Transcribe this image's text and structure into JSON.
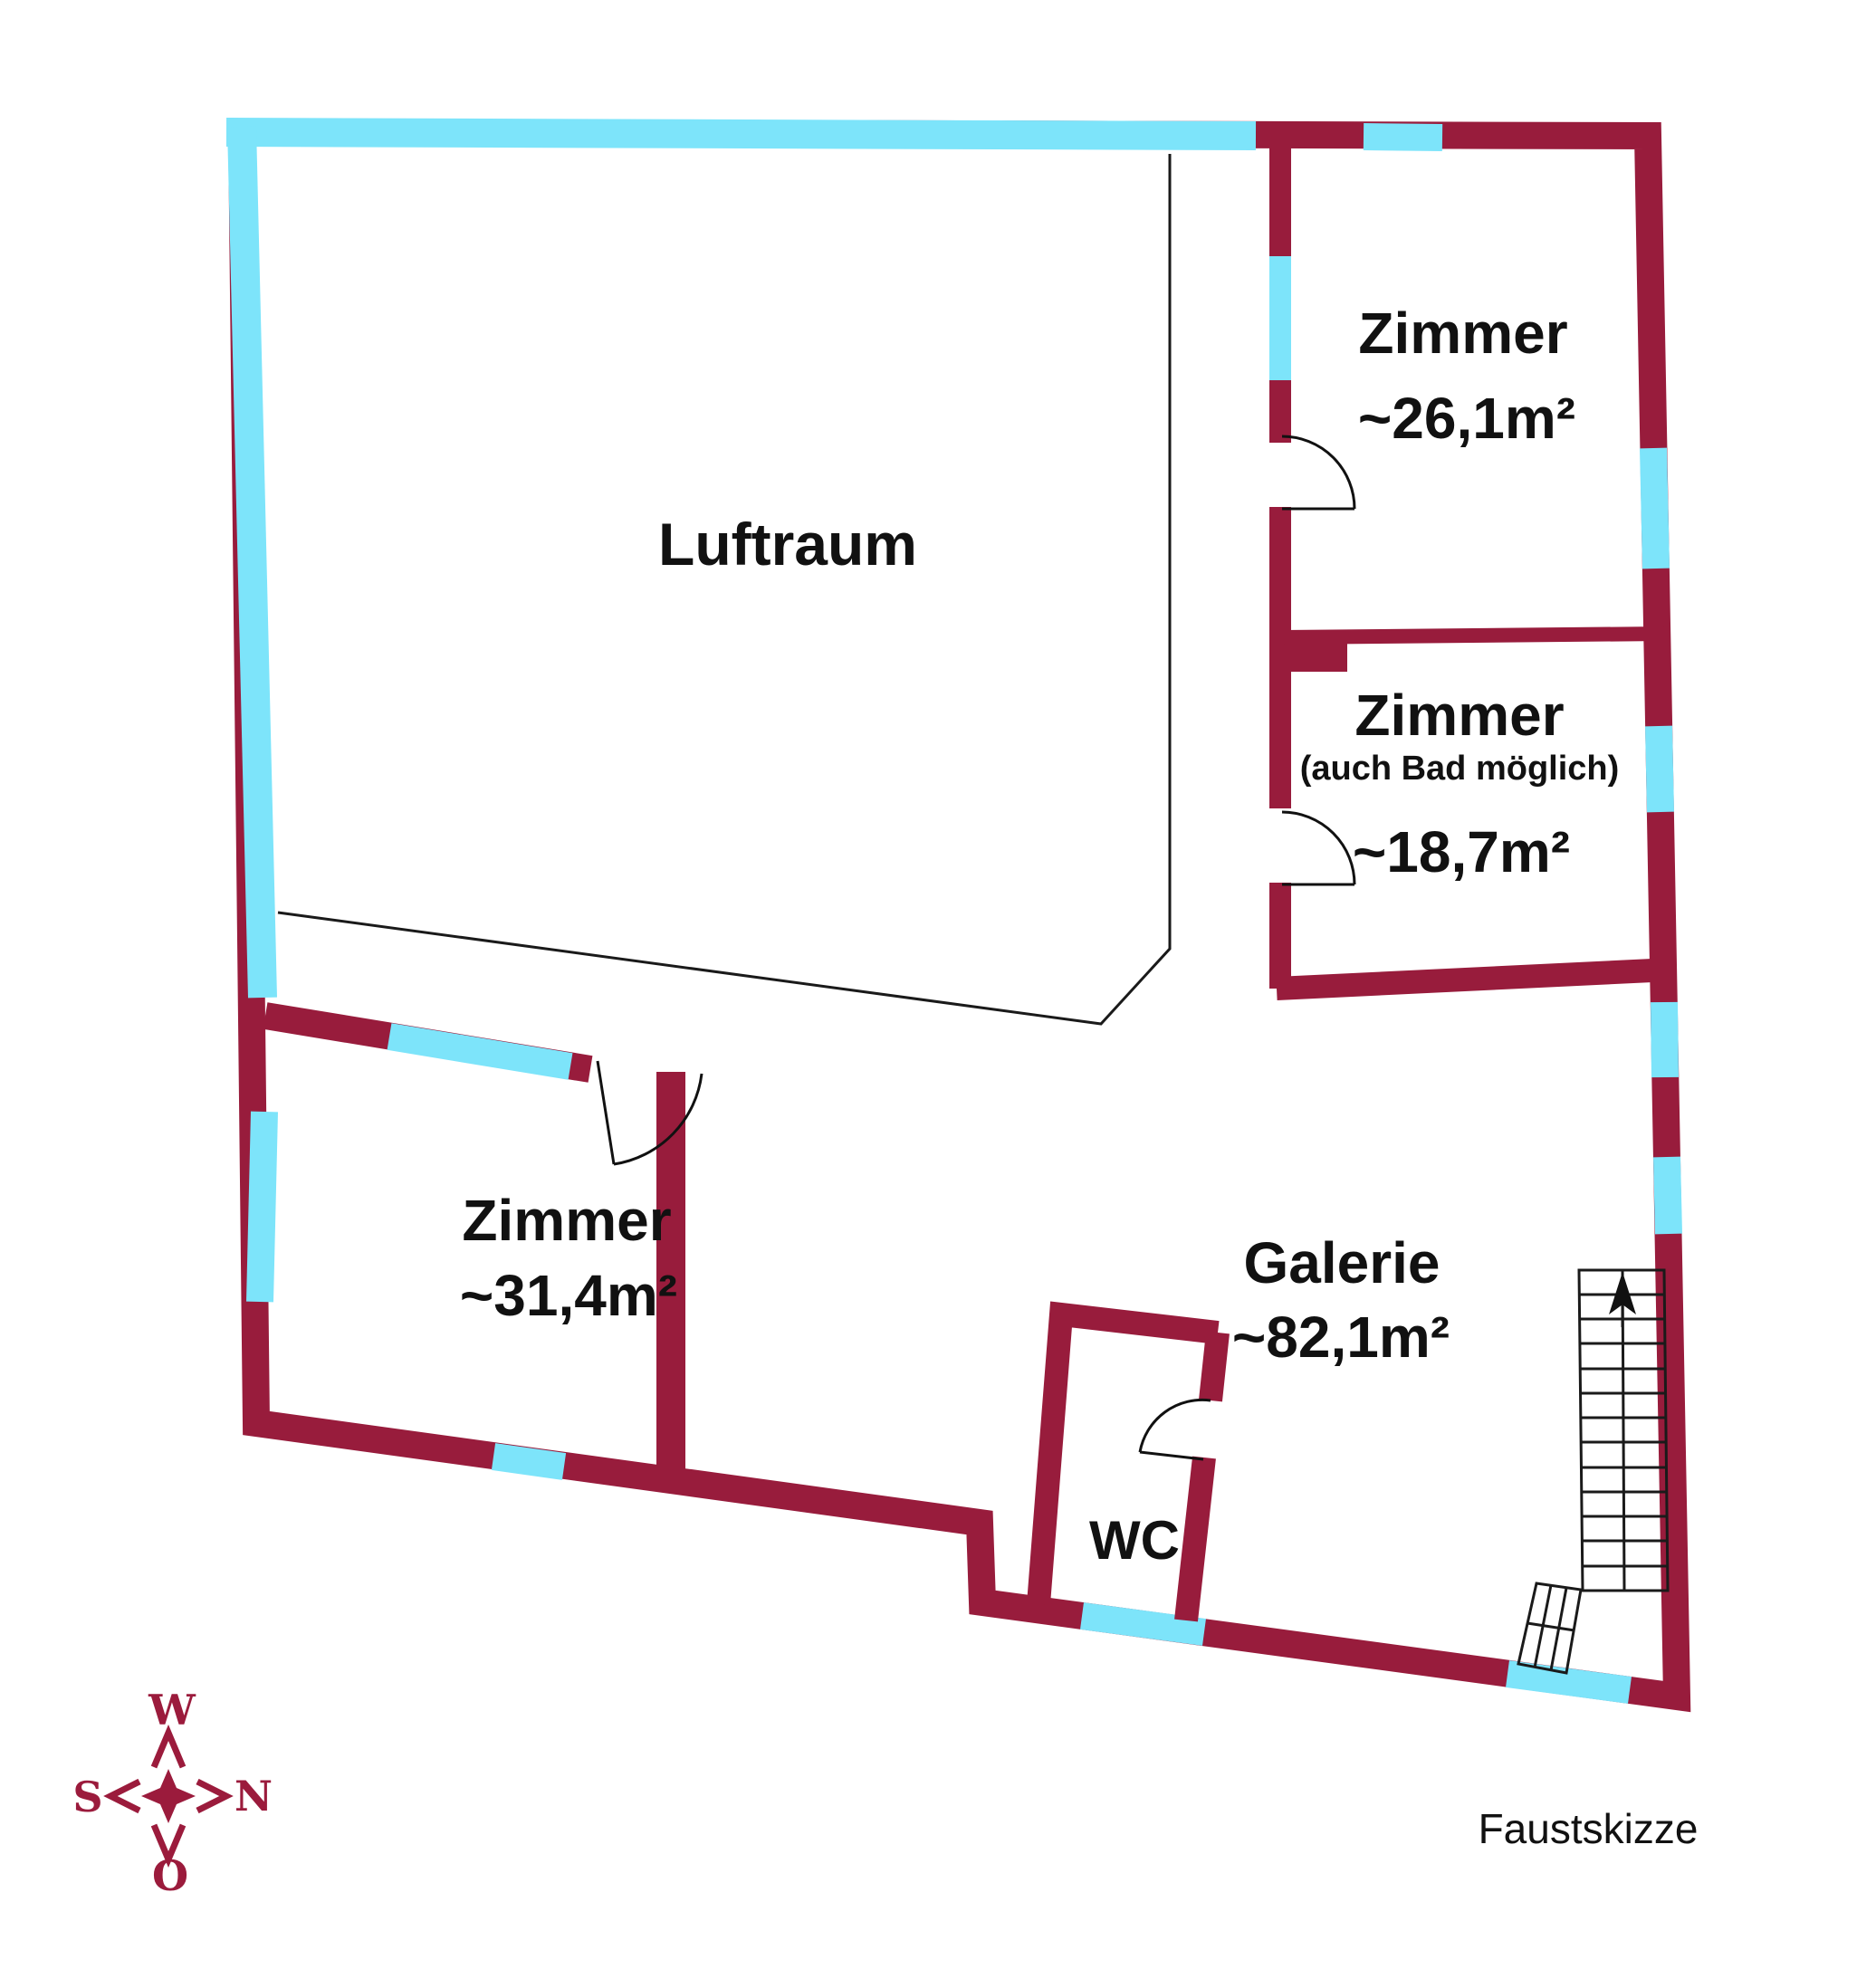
{
  "document": {
    "type": "floor-plan-sketch",
    "caption": "Faustskizze"
  },
  "colors": {
    "wall": "#981C3C",
    "window": "#7DE4FA",
    "line": "#1A1A1A",
    "background": "#FFFFFF",
    "compass": "#9B1B3C"
  },
  "rooms": [
    {
      "id": "luftraum",
      "name": "Luftraum",
      "area": ""
    },
    {
      "id": "zimmer-ne",
      "name": "Zimmer",
      "area": "~26,1m²"
    },
    {
      "id": "zimmer-e",
      "name": "Zimmer",
      "note": "(auch Bad möglich)",
      "area": "~18,7m²"
    },
    {
      "id": "zimmer-sw",
      "name": "Zimmer",
      "area": "~31,4m²"
    },
    {
      "id": "galerie",
      "name": "Galerie",
      "area": "~82,1m²"
    },
    {
      "id": "wc",
      "name": "WC"
    }
  ],
  "compass": {
    "top": "W",
    "right": "N",
    "left": "S",
    "bottom": "O"
  },
  "icons": {
    "stairs_arrow": "arrow-up"
  }
}
